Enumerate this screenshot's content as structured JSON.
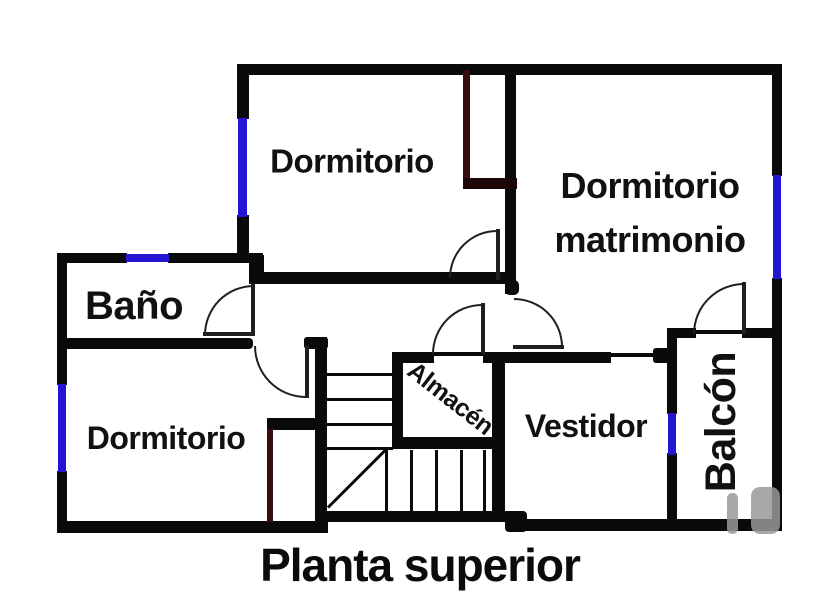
{
  "title": {
    "text": "Planta superior",
    "top": 538,
    "size": 46
  },
  "colors": {
    "wall": "#0a0a0a",
    "window": "#2315d3",
    "closet": "#380d0d",
    "closet_dark": "#1c0606",
    "door": "#1f1f1f",
    "text": "#111111",
    "watermark": "#999999",
    "background": "#ffffff"
  },
  "rooms": [
    {
      "id": "dormitorio-top",
      "label": "Dormitorio",
      "cx": 352,
      "cy": 161,
      "size": 33,
      "rotate": 0
    },
    {
      "id": "dormitorio-matrimonio",
      "label": "Dormitorio\nmatrimonio",
      "cx": 650,
      "cy": 213,
      "size": 36,
      "rotate": 0,
      "line_height": 54
    },
    {
      "id": "bano",
      "label": "Baño",
      "cx": 134,
      "cy": 306,
      "size": 40,
      "rotate": 0
    },
    {
      "id": "dormitorio-bottom",
      "label": "Dormitorio",
      "cx": 166,
      "cy": 438,
      "size": 32,
      "rotate": 0
    },
    {
      "id": "almacen",
      "label": "Almacén",
      "cx": 450,
      "cy": 399,
      "size": 25,
      "rotate": 38
    },
    {
      "id": "vestidor",
      "label": "Vestidor",
      "cx": 586,
      "cy": 426,
      "size": 32,
      "rotate": 0
    },
    {
      "id": "balcon",
      "label": "Balcón",
      "cx": 722,
      "cy": 422,
      "size": 43,
      "rotate": -90
    }
  ],
  "geometry": {
    "walls": [
      [
        237,
        64,
        545,
        11
      ],
      [
        772,
        64,
        10,
        112
      ],
      [
        772,
        278,
        10,
        252
      ],
      [
        57,
        253,
        10,
        132
      ],
      [
        57,
        471,
        10,
        62
      ],
      [
        57,
        521,
        271,
        12
      ],
      [
        318,
        511,
        196,
        11
      ],
      [
        505,
        511,
        22,
        21,
        4
      ],
      [
        513,
        519,
        269,
        12
      ],
      [
        237,
        64,
        12,
        55
      ],
      [
        237,
        215,
        12,
        48
      ],
      [
        249,
        255,
        15,
        29
      ],
      [
        57,
        253,
        70,
        10
      ],
      [
        168,
        253,
        95,
        10
      ],
      [
        250,
        272,
        257,
        12
      ],
      [
        505,
        64,
        11,
        230
      ],
      [
        505,
        280,
        14,
        15,
        5
      ],
      [
        57,
        338,
        196,
        11,
        4
      ],
      [
        304,
        337,
        24,
        12,
        3
      ],
      [
        315,
        337,
        12,
        186
      ],
      [
        267,
        418,
        51,
        12
      ],
      [
        392,
        352,
        42,
        11
      ],
      [
        483,
        352,
        128,
        11
      ],
      [
        653,
        348,
        20,
        15,
        3
      ],
      [
        392,
        352,
        11,
        97
      ],
      [
        492,
        352,
        13,
        167
      ],
      [
        392,
        437,
        112,
        12
      ],
      [
        667,
        328,
        29,
        10
      ],
      [
        742,
        328,
        40,
        10
      ],
      [
        667,
        328,
        10,
        86
      ],
      [
        667,
        453,
        10,
        75
      ]
    ],
    "closet_walls": [
      [
        463,
        70,
        7,
        112
      ],
      [
        267,
        429,
        6,
        93
      ]
    ],
    "closet_dark_walls": [
      [
        463,
        178,
        54,
        11
      ]
    ],
    "windows": [
      [
        238,
        118,
        9,
        99
      ],
      [
        126,
        254,
        43,
        8
      ],
      [
        773,
        175,
        8,
        104
      ],
      [
        58,
        384,
        8,
        88
      ],
      [
        668,
        413,
        8,
        42
      ]
    ],
    "thin_lines": [
      [
        433,
        352,
        52,
        4
      ],
      [
        610,
        353,
        44,
        4
      ],
      [
        694,
        330,
        50,
        4
      ],
      [
        327,
        373,
        66,
        3
      ],
      [
        327,
        398,
        66,
        3
      ],
      [
        327,
        423,
        66,
        3
      ],
      [
        327,
        447,
        66,
        3
      ],
      [
        385,
        450,
        3,
        61
      ],
      [
        410,
        450,
        3,
        61
      ],
      [
        435,
        450,
        3,
        61
      ],
      [
        460,
        450,
        3,
        61
      ],
      [
        483,
        450,
        3,
        61
      ]
    ],
    "door_leaves": [
      [
        203,
        332,
        51,
        4
      ],
      [
        251,
        283,
        4,
        53
      ],
      [
        496,
        229,
        4,
        51
      ],
      [
        513,
        345,
        51,
        4
      ],
      [
        481,
        303,
        4,
        51
      ],
      [
        742,
        282,
        4,
        52
      ],
      [
        305,
        345,
        4,
        53
      ]
    ],
    "door_arcs": [
      {
        "x": 204,
        "y": 285,
        "s": 50,
        "c": "tl"
      },
      {
        "x": 449,
        "y": 230,
        "s": 48,
        "c": "tl"
      },
      {
        "x": 514,
        "y": 298,
        "s": 49,
        "c": "tr"
      },
      {
        "x": 432,
        "y": 304,
        "s": 50,
        "c": "tl"
      },
      {
        "x": 693,
        "y": 283,
        "s": 51,
        "c": "tl"
      },
      {
        "x": 254,
        "y": 346,
        "s": 52,
        "c": "bl"
      }
    ],
    "stair_diagonal": {
      "x": 328,
      "y": 506,
      "len": 84,
      "angle": -45
    },
    "watermark": [
      [
        727,
        493,
        11,
        41,
        5
      ],
      [
        751,
        487,
        29,
        47,
        9
      ]
    ]
  }
}
